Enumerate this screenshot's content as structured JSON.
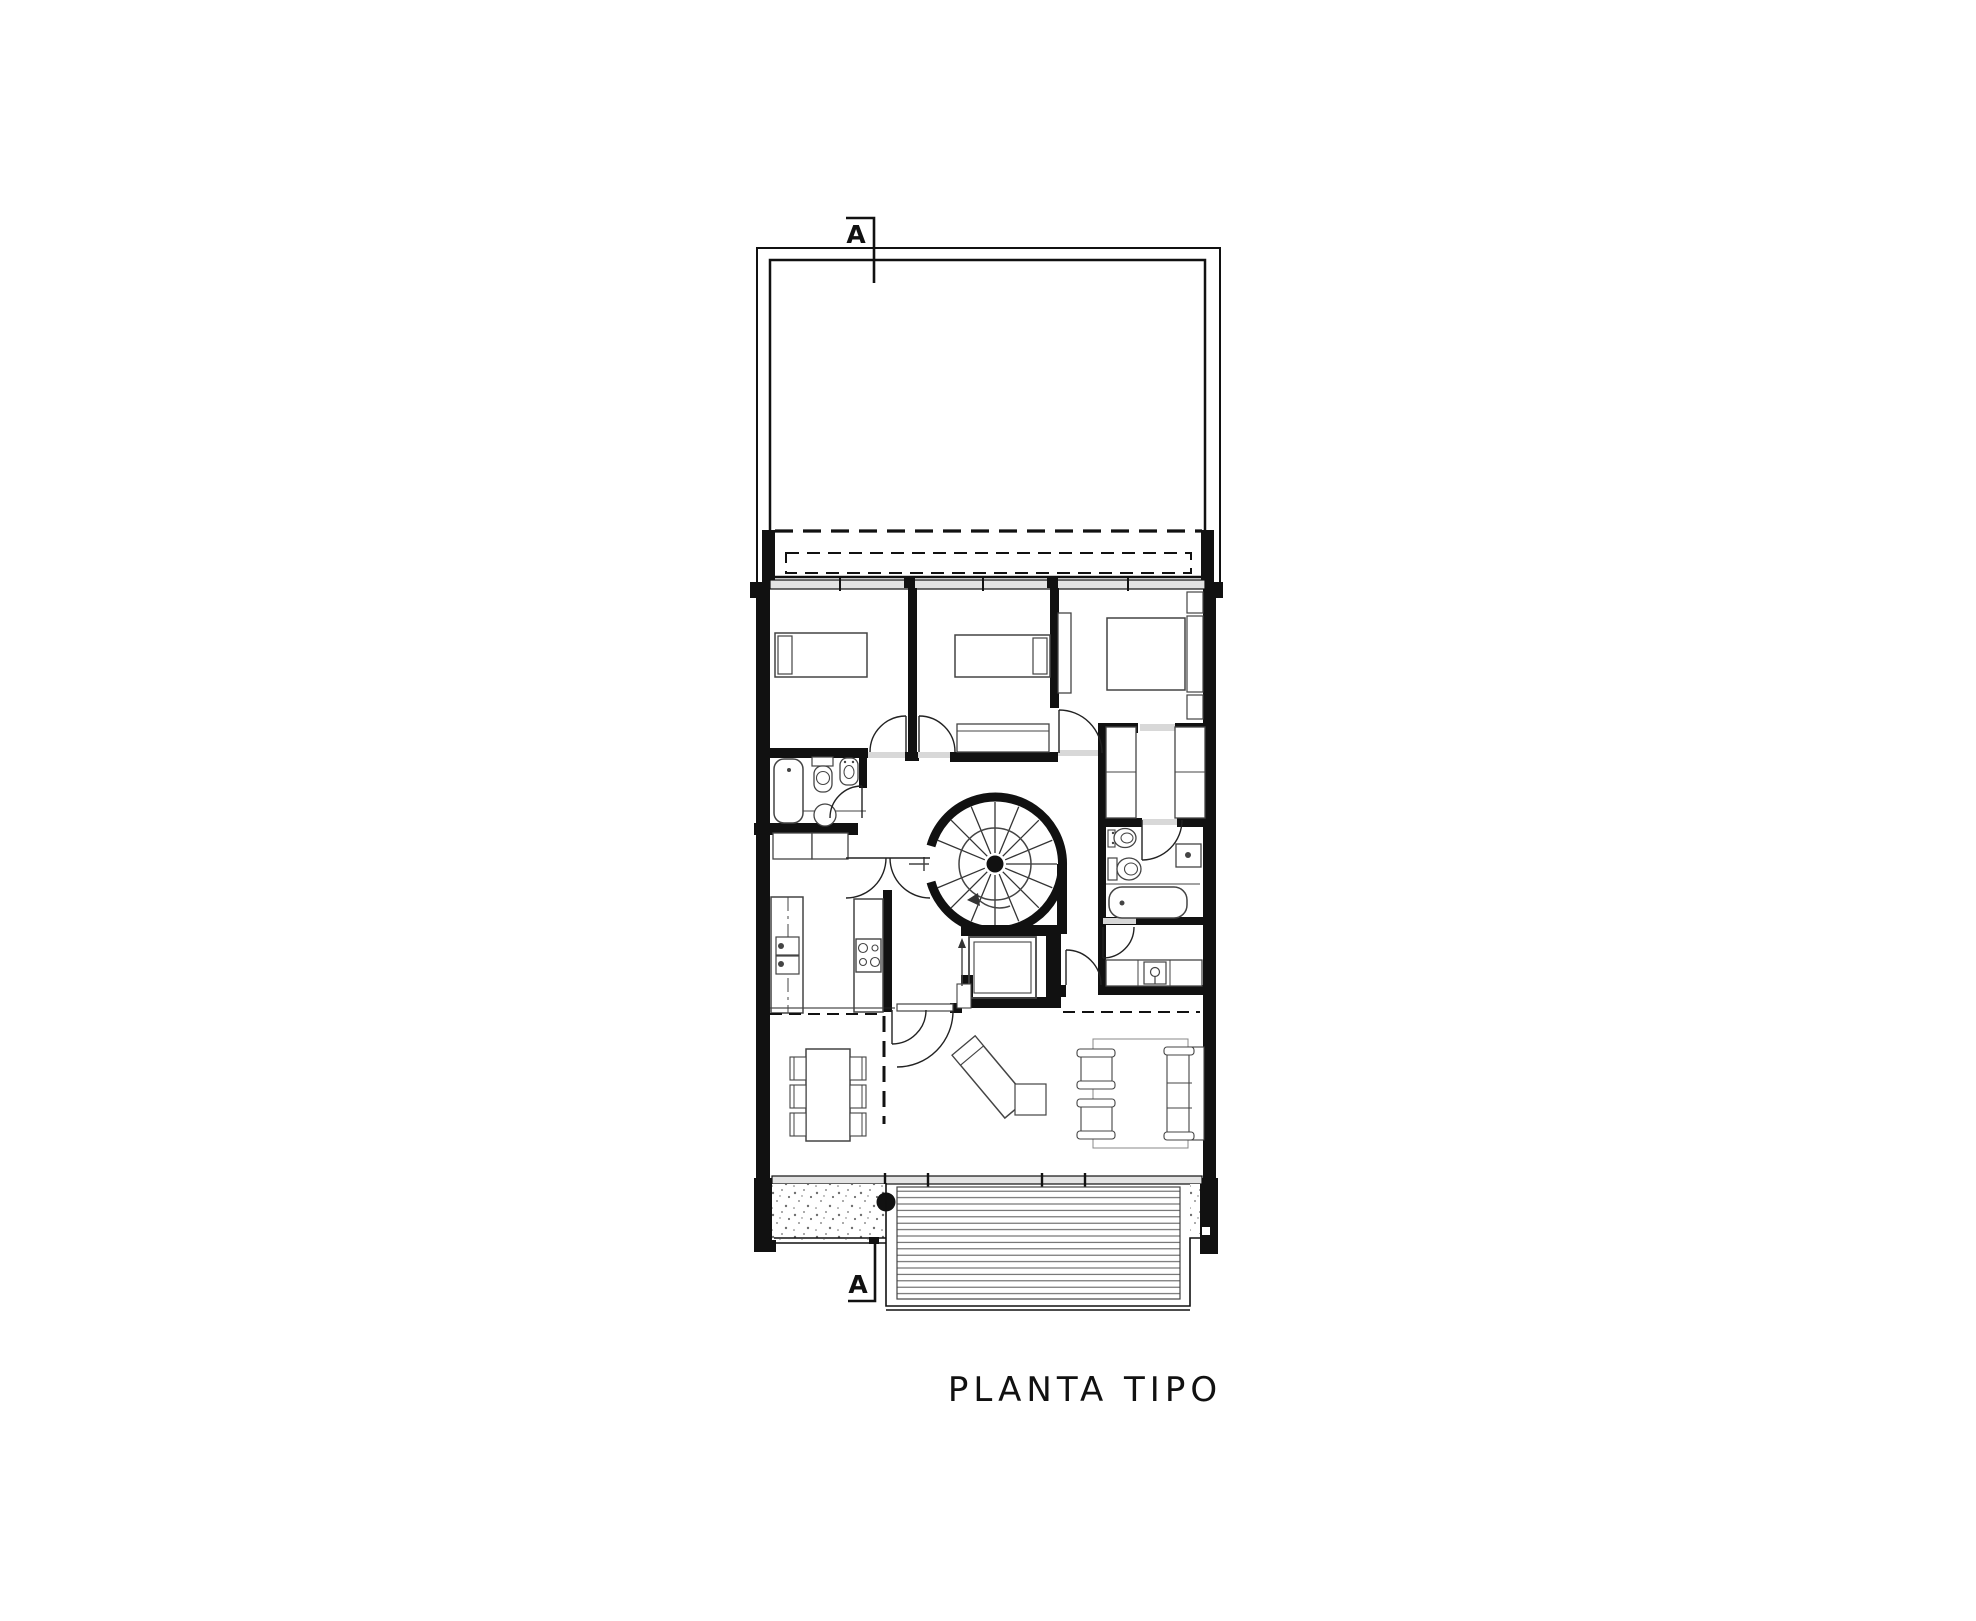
{
  "drawing_title": {
    "label": "PLANTA TIPO"
  },
  "section_markers": {
    "top_label": "A",
    "bottom_label": "A"
  },
  "palette": {
    "ink": "#111111",
    "background": "#ffffff",
    "glass_band": "#e3e3e3",
    "stipple_dots": "#6f6f6f",
    "furniture_line": "#444444"
  }
}
